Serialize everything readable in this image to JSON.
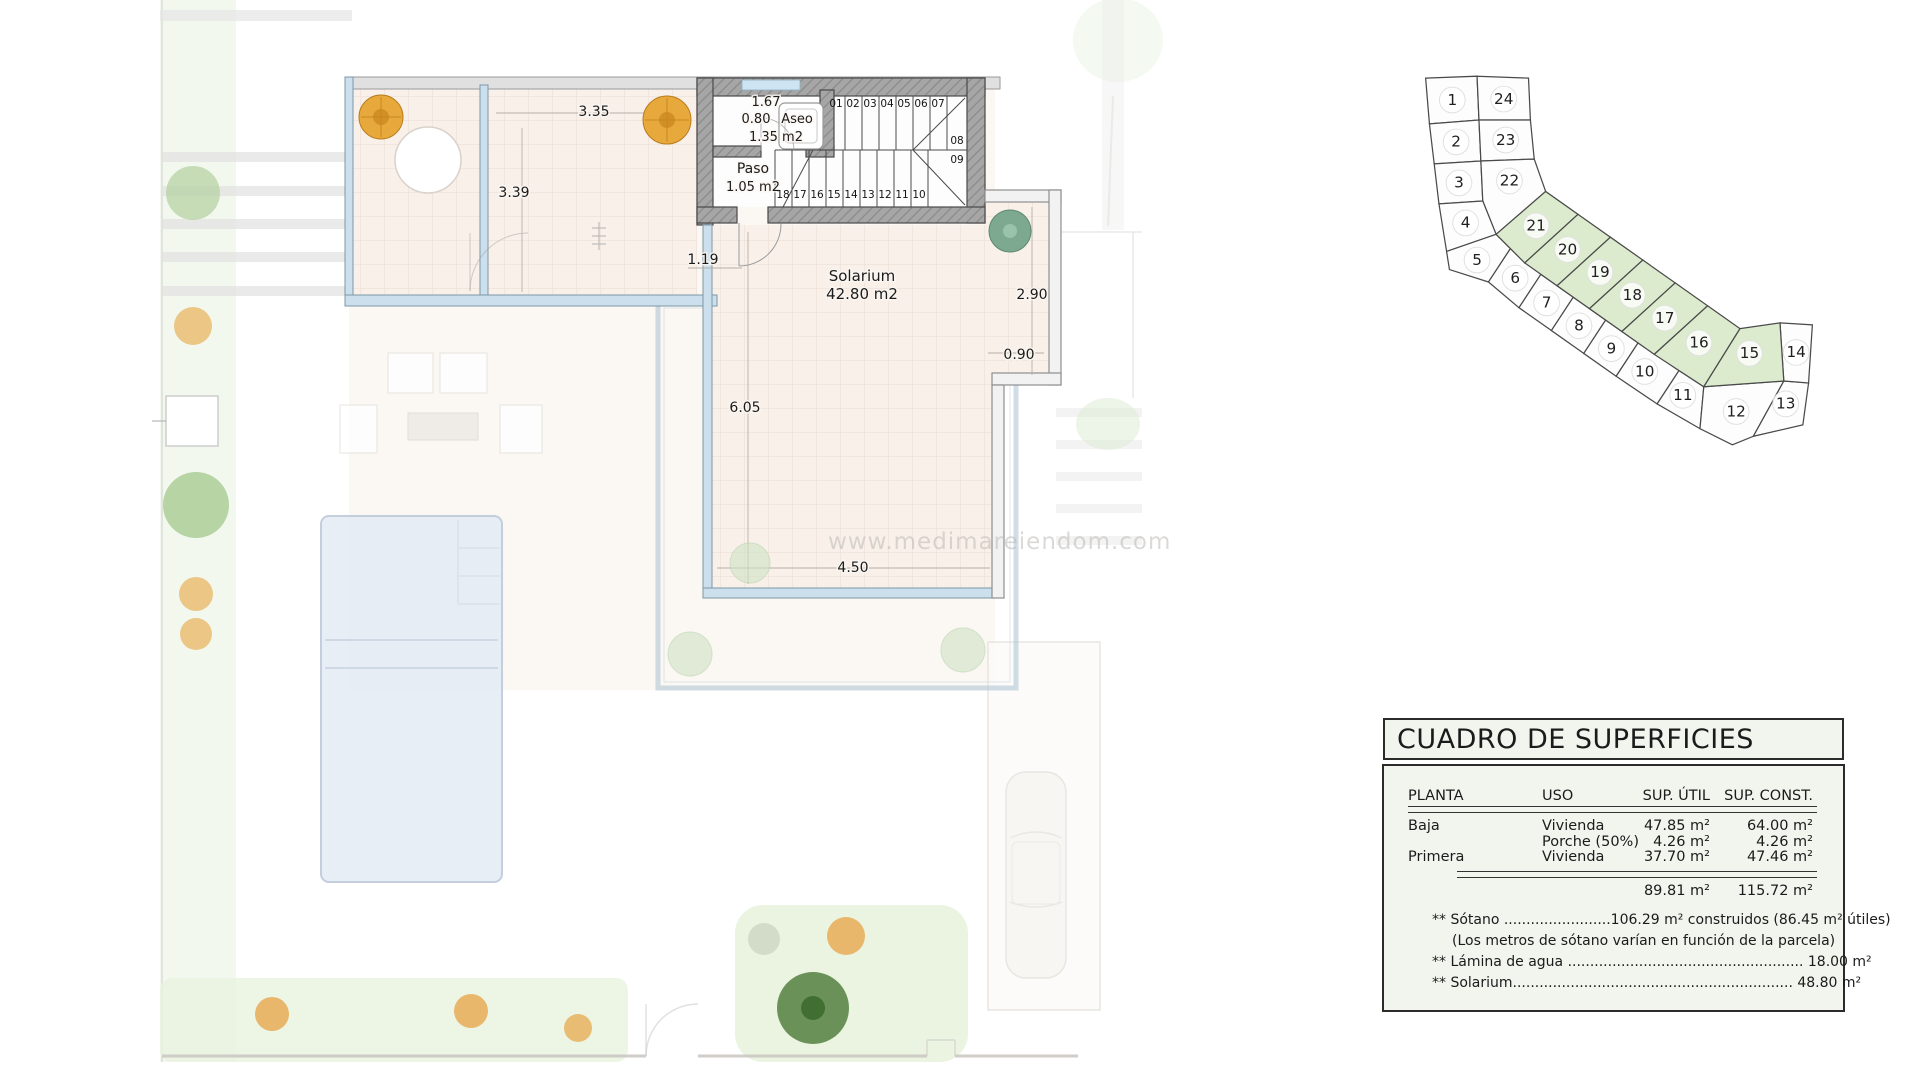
{
  "watermark": "www.medimareiendom.com",
  "floor_plan": {
    "texts": [
      {
        "t": "3.35",
        "x": 594,
        "y": 116,
        "fs": 14
      },
      {
        "t": "3.39",
        "x": 514,
        "y": 197,
        "fs": 14
      },
      {
        "t": "1.19",
        "x": 703,
        "y": 264,
        "fs": 14
      },
      {
        "t": "1.67",
        "x": 766,
        "y": 106,
        "fs": 13
      },
      {
        "t": "0.80",
        "x": 756,
        "y": 123,
        "fs": 13
      },
      {
        "t": "Aseo",
        "x": 797,
        "y": 123,
        "fs": 13
      },
      {
        "t": "1.35 m2",
        "x": 776,
        "y": 141,
        "fs": 13
      },
      {
        "t": "Paso",
        "x": 753,
        "y": 173,
        "fs": 14
      },
      {
        "t": "1.05 m2",
        "x": 753,
        "y": 191,
        "fs": 13
      },
      {
        "t": "Solarium",
        "x": 862,
        "y": 281,
        "fs": 15
      },
      {
        "t": "42.80 m2",
        "x": 862,
        "y": 299,
        "fs": 15
      },
      {
        "t": "2.90",
        "x": 1032,
        "y": 299,
        "fs": 14
      },
      {
        "t": "0.90",
        "x": 1019,
        "y": 359,
        "fs": 14
      },
      {
        "t": "6.05",
        "x": 745,
        "y": 412,
        "fs": 14
      },
      {
        "t": "4.50",
        "x": 853,
        "y": 572,
        "fs": 14
      }
    ],
    "stair_numbers": [
      {
        "t": "01",
        "x": 836,
        "y": 107
      },
      {
        "t": "02",
        "x": 853,
        "y": 107
      },
      {
        "t": "03",
        "x": 870,
        "y": 107
      },
      {
        "t": "04",
        "x": 887,
        "y": 107
      },
      {
        "t": "05",
        "x": 904,
        "y": 107
      },
      {
        "t": "06",
        "x": 921,
        "y": 107
      },
      {
        "t": "07",
        "x": 938,
        "y": 107
      },
      {
        "t": "08",
        "x": 957,
        "y": 144
      },
      {
        "t": "09",
        "x": 957,
        "y": 163
      },
      {
        "t": "18",
        "x": 783,
        "y": 198
      },
      {
        "t": "17",
        "x": 800,
        "y": 198
      },
      {
        "t": "16",
        "x": 817,
        "y": 198
      },
      {
        "t": "15",
        "x": 834,
        "y": 198
      },
      {
        "t": "14",
        "x": 851,
        "y": 198
      },
      {
        "t": "13",
        "x": 868,
        "y": 198
      },
      {
        "t": "12",
        "x": 885,
        "y": 198
      },
      {
        "t": "11",
        "x": 902,
        "y": 198
      },
      {
        "t": "10",
        "x": 919,
        "y": 198
      }
    ]
  },
  "plot_map": {
    "highlight_color": "#dcebce",
    "plot_fill": "#fdfdfd",
    "plots": [
      {
        "n": "1",
        "pts": "8,14 62,12 64,58 12,62",
        "g": false,
        "x": 36,
        "y": 37
      },
      {
        "n": "24",
        "pts": "62,12 116,14 118,58 64,58",
        "g": false,
        "x": 90,
        "y": 36
      },
      {
        "n": "2",
        "pts": "12,62 64,58 66,101 17,104",
        "g": false,
        "x": 40,
        "y": 81
      },
      {
        "n": "23",
        "pts": "64,58 118,58 122,99 66,101",
        "g": false,
        "x": 92,
        "y": 79
      },
      {
        "n": "3",
        "pts": "17,104 66,101 68,143 22,146",
        "g": false,
        "x": 43,
        "y": 124
      },
      {
        "n": "22",
        "pts": "66,101 122,99 134,133 82,178 68,143",
        "g": false,
        "x": 96,
        "y": 122
      },
      {
        "n": "4",
        "pts": "22,146 68,143 82,178 30,196",
        "g": false,
        "x": 50,
        "y": 166
      },
      {
        "n": "5",
        "pts": "30,196 82,178 97,193 74,228 33,215",
        "g": false,
        "x": 62,
        "y": 205
      },
      {
        "n": "6",
        "pts": "97,193 129,220 106,255 74,228",
        "g": false,
        "x": 102,
        "y": 224
      },
      {
        "n": "7",
        "pts": "129,220 163,244 140,279 106,255",
        "g": false,
        "x": 135,
        "y": 250
      },
      {
        "n": "8",
        "pts": "163,244 197,268 174,303 140,279",
        "g": false,
        "x": 169,
        "y": 274
      },
      {
        "n": "9",
        "pts": "197,268 231,292 208,327 174,303",
        "g": false,
        "x": 203,
        "y": 298
      },
      {
        "n": "10",
        "pts": "231,292 274,321 251,356 208,327",
        "g": false,
        "x": 238,
        "y": 322
      },
      {
        "n": "11",
        "pts": "274,321 300,338 296,382 251,356",
        "g": false,
        "x": 278,
        "y": 347
      },
      {
        "n": "12",
        "pts": "300,338 384,332 352,390 330,399 296,382",
        "g": false,
        "x": 334,
        "y": 364
      },
      {
        "n": "13",
        "pts": "384,332 410,334 404,378 352,390",
        "g": false,
        "x": 386,
        "y": 356
      },
      {
        "n": "14",
        "pts": "380,271 414,273 410,334 384,332",
        "g": false,
        "x": 397,
        "y": 302
      },
      {
        "n": "21",
        "pts": "82,178 134,133 168,157 112,208",
        "g": true,
        "x": 124,
        "y": 169
      },
      {
        "n": "20",
        "pts": "168,157 202,181 146,232 112,208",
        "g": true,
        "x": 157,
        "y": 194
      },
      {
        "n": "19",
        "pts": "202,181 236,205 180,256 146,232",
        "g": true,
        "x": 191,
        "y": 218
      },
      {
        "n": "18",
        "pts": "236,205 270,229 214,280 180,256",
        "g": true,
        "x": 225,
        "y": 242
      },
      {
        "n": "17",
        "pts": "270,229 304,253 248,304 214,280",
        "g": true,
        "x": 259,
        "y": 266
      },
      {
        "n": "16",
        "pts": "304,253 338,277 300,338 248,304",
        "g": true,
        "x": 295,
        "y": 292
      },
      {
        "n": "15",
        "pts": "338,277 380,271 384,332 300,338",
        "g": true,
        "x": 348,
        "y": 303
      }
    ]
  },
  "table": {
    "title": "CUADRO DE SUPERFICIES",
    "headers": {
      "planta": "PLANTA",
      "uso": "USO",
      "util": "SUP. ÚTIL",
      "construida": "SUP. CONST."
    },
    "rows": [
      {
        "planta": "Baja",
        "uso": "Vivienda",
        "util": "47.85 m²",
        "construida": "64.00 m²"
      },
      {
        "planta": "",
        "uso": "Porche (50%)",
        "util": "4.26 m²",
        "construida": "4.26 m²"
      },
      {
        "planta": "Primera",
        "uso": "Vivienda",
        "util": "37.70 m²",
        "construida": "47.46 m²"
      }
    ],
    "totals": {
      "util": "89.81 m²",
      "construida": "115.72  m²"
    },
    "notes": [
      "** Sótano ........................106.29 m² construidos (86.45 m² útiles)",
      "(Los metros de sótano varían en función de la parcela)",
      "** Lámina de agua ..................................................... 18.00 m²",
      "** Solarium............................................................... 48.80 m²"
    ]
  }
}
